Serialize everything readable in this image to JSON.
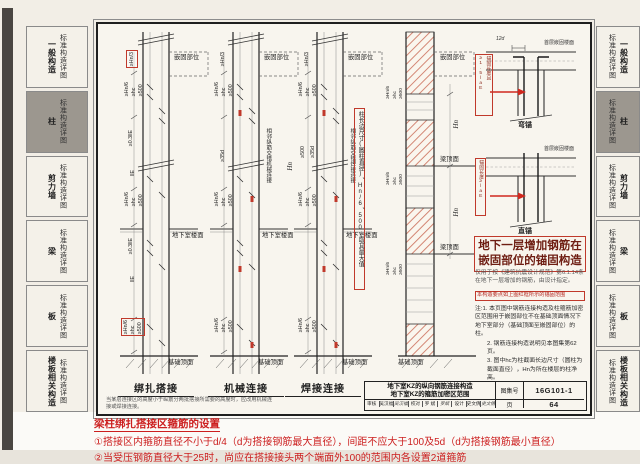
{
  "sidebar": {
    "detail_label": "标准构造详图",
    "tabs": [
      {
        "category": "一般构造",
        "active": false
      },
      {
        "category": "柱",
        "active": true
      },
      {
        "category": "剪力墙",
        "active": false
      },
      {
        "category": "梁",
        "active": false
      },
      {
        "category": "板",
        "active": false
      },
      {
        "category": "楼板相关构造",
        "active": false
      }
    ]
  },
  "diagram": {
    "captions": {
      "lap": "绑扎搭接",
      "mech": "机械连接",
      "weld": "焊接连接"
    },
    "lap_note": "当某层连接区的高度小于纵筋分两批搭接所需要的高度时，应改用机械连接或焊接连接。",
    "labels": {
      "embed": "嵌固部位",
      "basement_floor": "地下室楼面",
      "foundation_top": "基础顶面",
      "beam_top": "梁顶面",
      "hn": "Hn",
      "dim_hn3": "≥Hn/3",
      "dim_hn6": "≥Hn/6",
      "dim_hc": "≥hc",
      "dim_500": "≥500",
      "dim_03lle": "≥0.3llE",
      "dim_lle": "llE",
      "dim_35d": "≥35d",
      "dim_12d": "12d",
      "mech_vert": "相邻纵筋交错机械连接",
      "weld_vert": "相邻纵筋交错焊接连接",
      "max_rule": "柱长边尺寸(圆柱直径)、Hn/6、500,取其最大值",
      "first_floor": "首层嵌固楼面",
      "bend": "弯锚",
      "straight": "直锚",
      "bend_anchor": "锚固长度且≥1.5laE",
      "straight_anchor": "锚固长度≥laE"
    },
    "detail_title_l1": "地下一层增加钢筋在",
    "detail_title_l2": "嵌固部位的锚固构造",
    "detail_note": "仅用于按《建筑抗震设计规范》第6.1.14条在地下一层增加的钢筋，由设计指定。",
    "detail_highlight": "本构造要点如上图红框所示的锚固范围",
    "notes": [
      "注:1. 本页图中钢筋连接构造及柱箍筋加密区范围用于嵌固部位不在基础顶面情况下地下室部分（基础顶面至嵌固部位）的柱。",
      "2. 钢筋连接构造说明见本图集第62页。",
      "3. 图中hc为柱截面长边尺寸（圆柱为截面直径），Hn为所在楼层的柱净高。"
    ]
  },
  "titleblock": {
    "title_line1": "地下室KZ的纵向钢筋连接构造",
    "title_line2": "地下室KZ的箍筋加密区范围",
    "atlas_label": "图集号",
    "atlas_no": "16G101-1",
    "page_label": "页",
    "page_no": "64",
    "sig": [
      "审核",
      "吴汉福",
      "吴汉福",
      "校对",
      "罗 斌",
      "罗斌",
      "设计",
      "史文倩",
      "史文倩"
    ]
  },
  "annotation": {
    "heading": "梁柱绑扎搭接区箍筋的设置",
    "item1": "①搭接区内箍筋直径不小于d/4（d为搭接钢筋最大直径），间距不应大于100及5d（d为搭接钢筋最小直径）",
    "item2": "②当受压钢筋直径大于25时，尚应在搭接接头两个端面外100的范围内各设置2道箍筋"
  },
  "colors": {
    "highlight": "#c0392b",
    "annotation": "#cc1f1f",
    "hatch": "#cf7a66"
  }
}
